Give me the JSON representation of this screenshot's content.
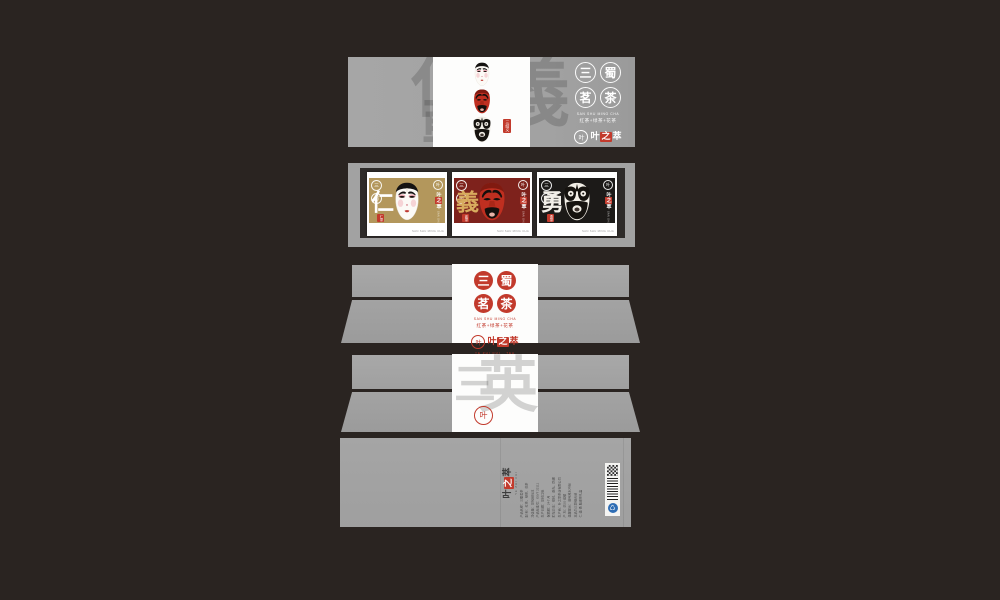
{
  "canvas": {
    "background_color": "#2a2421",
    "panel_gray": "#a2a2a2",
    "brand_red": "#c23a2c"
  },
  "brand": {
    "seal_chars": [
      "三",
      "蜀",
      "茗",
      "茶"
    ],
    "pinyin": "SAN SHU MING CHA",
    "tagline": "红茶+绿茶+花茶",
    "logo_chars": [
      "叶",
      "之",
      "萃"
    ],
    "logo_leaf": "叶",
    "logo_sub": "YE ZHI CUI · TEA",
    "watermark_sleeve": [
      "仁",
      "義",
      "勇"
    ],
    "watermark_lid": [
      "三",
      "英"
    ]
  },
  "sleeve": {
    "tag": "三结义"
  },
  "cards": [
    {
      "virtue": "仁",
      "stamp": "仁茶",
      "footer": "SAN SHU MING CHA",
      "bg": "#b3975c",
      "virtue_color": "#ffffff"
    },
    {
      "virtue": "義",
      "stamp": "義茶",
      "footer": "SAN SHU MING CHA",
      "bg": "#7e221c",
      "virtue_color": "#d8ab5e"
    },
    {
      "virtue": "勇",
      "stamp": "勇茶",
      "footer": "SAN SHU MING CHA",
      "bg": "#1c1a18",
      "virtue_color": "#f2efe8"
    }
  ],
  "back_panel": {
    "logo_sub": "YE ZHI CUI",
    "recycle_icon": "♺",
    "lines": [
      "产品名称：三蜀茗茶",
      "配 料：红茶、绿茶、花茶",
      "净含量：见包装标注",
      "产品标准号：GB/T 22111",
      "生产日期：见封口处",
      "保质期：24个月",
      "贮存方法：密封、避光、防潮",
      "生产商：叶之萃茶业有限公司",
      "产 地：四川·成都",
      "温馨提示：请用沸水冲泡",
      "本品为三款组合装",
      "仁·義·勇 脸谱茶礼盒"
    ]
  }
}
